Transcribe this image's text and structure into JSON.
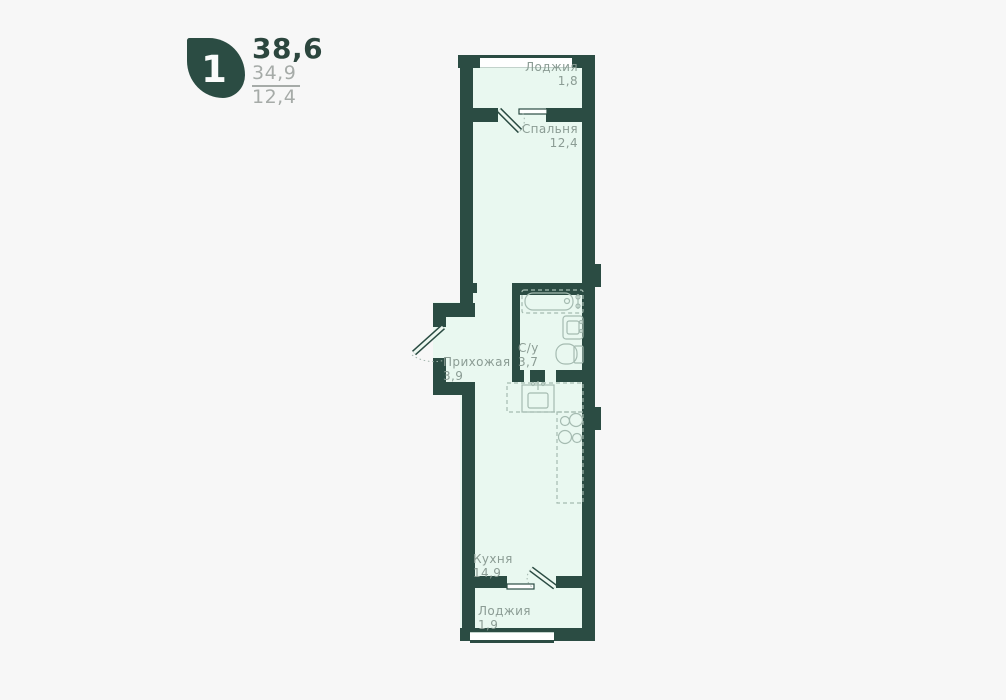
{
  "header": {
    "rooms_badge": "1",
    "total_area": "38,6",
    "living_area": "34,9",
    "extra_area": "12,4"
  },
  "plan": {
    "rooms": [
      {
        "name": "Лоджия",
        "area": "1,8"
      },
      {
        "name": "Спальня",
        "area": "12,4"
      },
      {
        "name": "Прихожая",
        "area": "3,9"
      },
      {
        "name": "С/у",
        "area": "3,7"
      },
      {
        "name": "Кухня",
        "area": "14,9"
      },
      {
        "name": "Лоджия",
        "area": "1,9"
      }
    ],
    "fixtures": [
      "bathtub",
      "washbasin",
      "toilet",
      "kitchen-sink",
      "stove",
      "counter"
    ],
    "colors": {
      "wall": "#2b4c43",
      "room_fill": "#e9f8f0",
      "background": "#f7f7f7",
      "fixture_line": "#a5bbb1",
      "label_text": "#8b9c94",
      "accent_dark": "#2c463e",
      "muted_text": "#a6aba8"
    }
  }
}
